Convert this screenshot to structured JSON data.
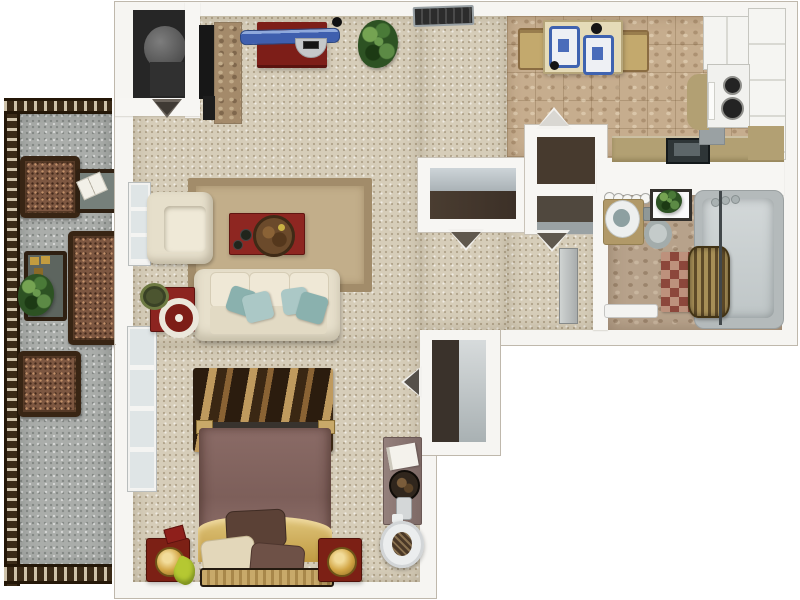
{
  "app": {
    "type": "3d-floor-plan-rendering",
    "title": "Studio Apartment 3D Floor Plan (top-down view)",
    "visible_text": []
  },
  "palette": {
    "background": "#ffffff",
    "wall": "#f6f5f2",
    "carpet": "#d6cdb9",
    "kitchen_tile": "#c6ad8e",
    "bathroom_tile": "#b7a28b",
    "balcony_concrete": "#aaadaa",
    "railing_wood": "#3a2a17",
    "accent_red": "#8c2420",
    "sofa_cream": "#e7e0cc",
    "pillow_teal": "#a9c6c4",
    "bed_mauve": "#7d5f5a",
    "bed_gold": "#c9a34b",
    "placemat_blue": "#3f63b0",
    "plant_green": "#2d5223",
    "closet_dark": "#46392e",
    "tub_gray": "#b4babb"
  },
  "rooms": [
    {
      "id": "balcony",
      "label": "Balcony / Patio",
      "floor": "concrete",
      "furniture": [
        "patio chair",
        "patio chair",
        "side table with open book",
        "patio bench",
        "patio table with candles",
        "potted plant"
      ]
    },
    {
      "id": "living-room",
      "label": "Living Room",
      "floor": "carpet",
      "furniture": [
        "sofa with teal throw pillows",
        "armchair",
        "red coffee table with round tray",
        "tan area rug",
        "red side table with decor plate",
        "TV console",
        "stone fireplace",
        "potted plant"
      ]
    },
    {
      "id": "sleeping-area",
      "label": "Sleeping Area",
      "floor": "carpet",
      "furniture": [
        "bed with mauve comforter and gold throw",
        "striped area rug",
        "two red nightstands with lamps",
        "desk",
        "round desk chair",
        "mirrored closet",
        "tall window"
      ]
    },
    {
      "id": "kitchen-dining",
      "label": "Kitchen / Dining",
      "floor": "tile",
      "furniture": [
        "dining table with two chairs and blue placemats",
        "range with burners",
        "refrigerator",
        "cabinet run",
        "countertop with sink",
        "ceiling vent"
      ]
    },
    {
      "id": "bathroom",
      "label": "Bathroom",
      "floor": "tile",
      "furniture": [
        "vanity with sink and six lights",
        "toilet",
        "bathtub with glass panel",
        "checkered bath rug",
        "wicker laundry hamper",
        "towel bar",
        "shelf with plant"
      ]
    },
    {
      "id": "entry-utility",
      "label": "Entry / Utility & Hall Closets",
      "furniture": [
        "utility closet with water heater",
        "wide hall closet with shelf",
        "double stacked closets",
        "open door markers"
      ]
    }
  ],
  "labels": {
    "balcony": "Balcony / Patio",
    "patio_chair": "Patio chair",
    "patio_bench": "Patio bench",
    "patio_table": "Patio side table",
    "open_book": "Open book",
    "potted_plant": "Potted plant",
    "sofa": "Sofa",
    "armchair": "Armchair",
    "coffee_table": "Coffee table",
    "area_rug": "Area rug",
    "side_table": "Side table",
    "tv_console": "TV console",
    "fireplace": "Fireplace",
    "bed": "Bed",
    "nightstand": "Nightstand",
    "lamp": "Lamp",
    "desk": "Desk",
    "desk_chair": "Round desk chair",
    "closet": "Closet",
    "mirror_closet": "Closet with mirror",
    "window": "Window",
    "dining_table": "Dining table",
    "dining_chair": "Dining chair",
    "placemat": "Placemat",
    "stove": "Range / stove",
    "refrigerator": "Refrigerator",
    "cabinets": "Kitchen cabinets",
    "countertop": "Countertop",
    "kitchen_sink": "Kitchen sink",
    "vanity": "Bathroom vanity",
    "vanity_light": "Vanity light",
    "toilet": "Toilet",
    "bathtub": "Bathtub",
    "bath_rug": "Checkered bath rug",
    "hamper": "Laundry hamper",
    "towel_bar": "Towel bar",
    "door": "Open door",
    "door_marker": "Door swing marker",
    "water_heater": "Water heater",
    "ceiling_vent": "Ceiling vent",
    "bedroom_rug": "Striped rug"
  }
}
